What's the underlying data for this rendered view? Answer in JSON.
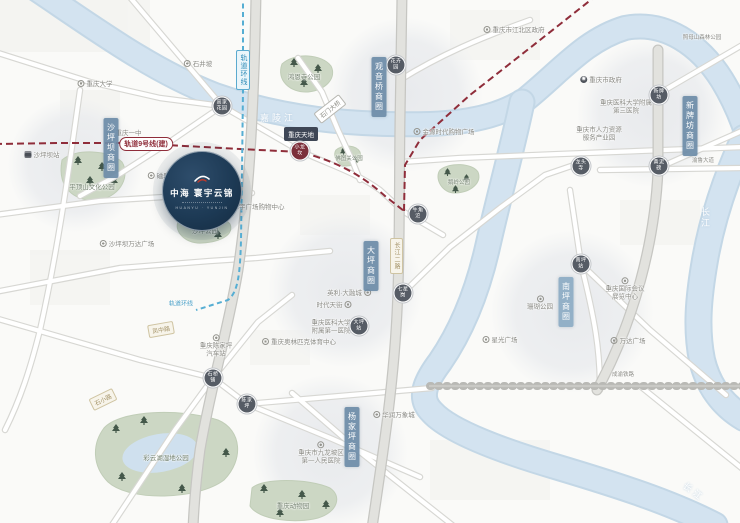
{
  "project": {
    "name": "中海 寰宇云锦",
    "tagline": "HUANYU · YUNJIN"
  },
  "districts": {
    "shapingba": "沙坪坝商圈",
    "guanyinqiao": "观音桥商圈",
    "xinpaifang": "新牌坊商圈",
    "daping": "大坪商圈",
    "nanping": "南坪商圈",
    "yangjiaping": "杨家坪商圈"
  },
  "rivers": {
    "jialingjiang": "嘉陵江",
    "changjiang_right": "长江",
    "changjiang_bottom": "长江"
  },
  "rail": {
    "line9": "轨道9号线(建)",
    "loop_top": "轨道环线",
    "loop_end": "轨道环线"
  },
  "stations": [
    {
      "l1": "高家",
      "l2": "花园"
    },
    {
      "l1": "小龙",
      "l2": "坎"
    },
    {
      "l1": "花卉",
      "l2": "园"
    },
    {
      "l1": "新牌",
      "l2": "坊"
    },
    {
      "l1": "黄泥",
      "l2": "磅"
    },
    {
      "l1": "龙头",
      "l2": "寺"
    },
    {
      "l1": "牛角",
      "l2": "沱"
    },
    {
      "l1": "大坪",
      "l2": "站"
    },
    {
      "l1": "七星",
      "l2": "岗"
    },
    {
      "l1": "石桥",
      "l2": "铺"
    },
    {
      "l1": "陈家",
      "l2": "坪"
    },
    {
      "l1": "南坪",
      "l2": "站"
    }
  ],
  "pois": {
    "cqu": "重庆大学",
    "shijingpo": "石井坡",
    "cqyizhong": "重庆一中",
    "spb_station": "沙坪坝站",
    "ciqikou": "磁器口",
    "huayu": "华宇广场购物中心",
    "wanda_spb": "沙坪坝万达广场",
    "cqtiandi": "重庆天地",
    "shimen_bridge": "石门大桥",
    "jinyuan": "金源时代购物广场",
    "jiangbei_gov": "重庆市江北区政府",
    "city_gov": "重庆市政府",
    "fu3_l1": "重庆医科大学附属",
    "fu3_l2": "第三医院",
    "hr_l1": "重庆市人力资源",
    "hr_l2": "服务产业园",
    "zhaomushan": "照母山森林公园",
    "yingli": "英利·大融城",
    "times_street": "时代天街",
    "fu1_l1": "重庆医科大学",
    "fu1_l2": "附属第一医院",
    "cjp_l1": "重庆陈家坪",
    "cjp_l2": "汽车站",
    "olympic": "重庆奥林匹克体育中心",
    "jlp_l1": "重庆市九龙坡区",
    "jlp_l2": "第一人民医院",
    "mixc": "华润万象城",
    "shanhu": "珊瑚公园",
    "expo_l1": "重庆国际会议",
    "expo_l2": "展览中心",
    "xingguang": "星光广场",
    "wanda_np": "万达广场",
    "yulu": "渝鲁大道",
    "railway": "成渝铁路"
  },
  "parks": {
    "pingdingshan": "平顶山文化公园",
    "hongensi": "鸿恩寺公园",
    "shaping": "沙坪公园",
    "futuguan": "佛图关公园",
    "eling": "鹅岭公园",
    "caiyunhu": "彩云湖湿地公园",
    "zoo": "重庆动物园"
  },
  "roads": {
    "cj2": "长江二路",
    "fengzhong": "凤中路",
    "shixiao": "石小路"
  },
  "colors": {
    "project_navy": "#1d3a55",
    "district_badge": "#6d8ca8",
    "river": "#d3e3f0",
    "park": "#ccd7c4",
    "rail9": "#8f2d3a",
    "loop_line": "#56aed3"
  }
}
